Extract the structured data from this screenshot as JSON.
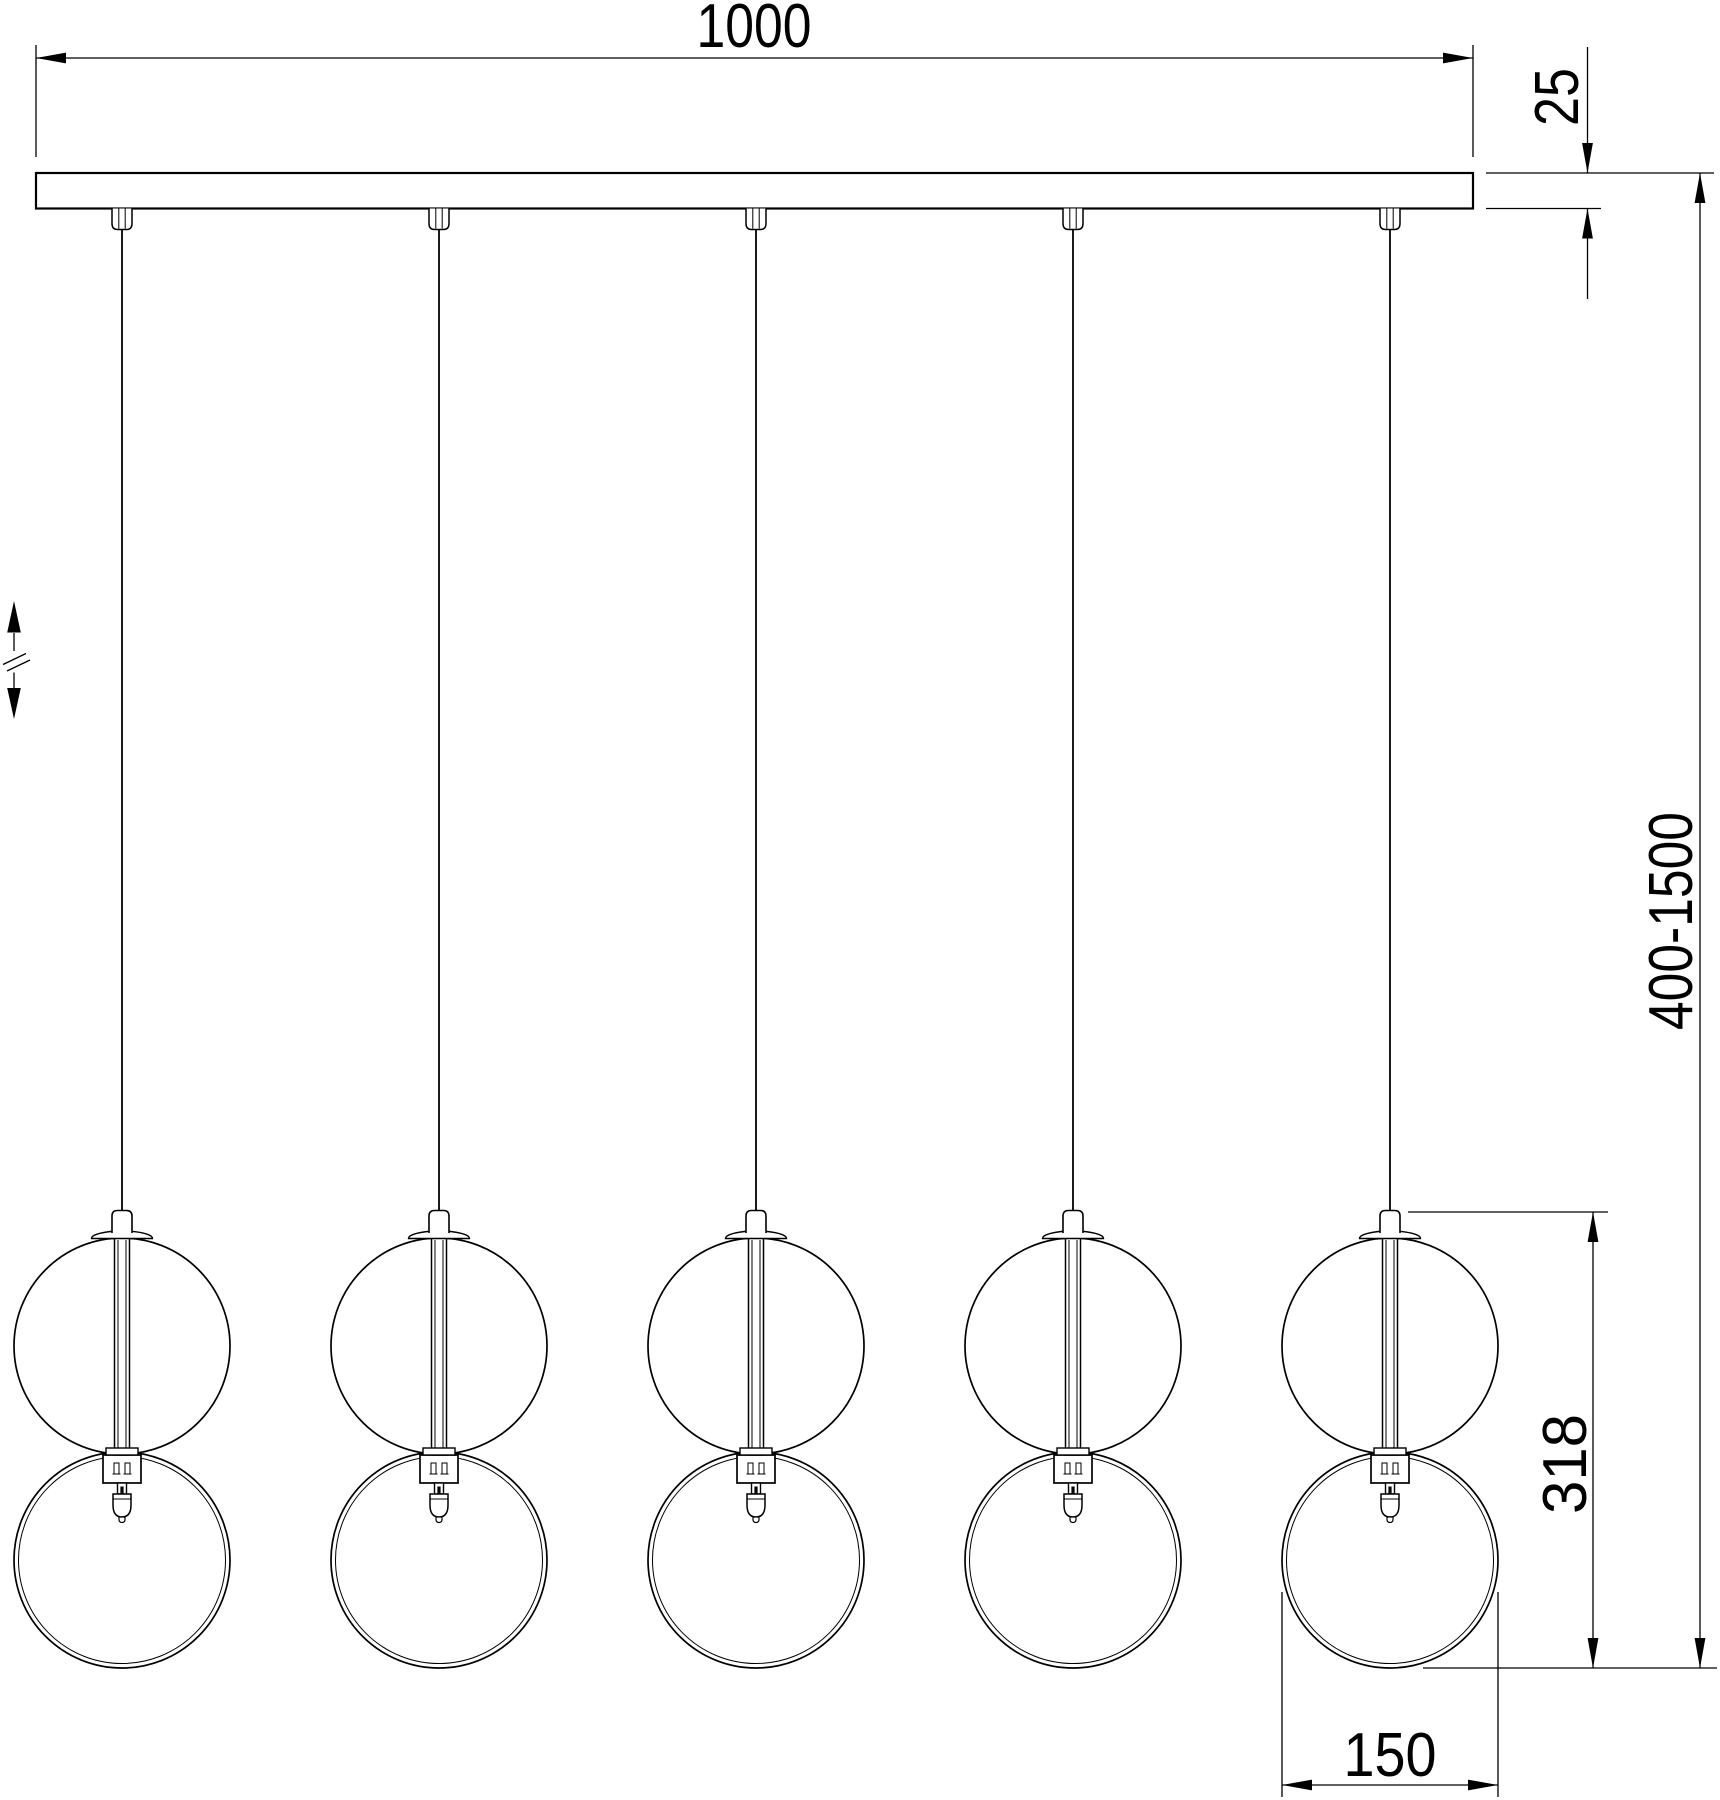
{
  "drawing": {
    "kind": "pendant-luminaire-dimension-drawing",
    "background_color": "#ffffff",
    "line_color": "#000000"
  },
  "dimensions": {
    "overall_width": "1000",
    "canopy_thickness": "25",
    "suspension_range": "400-1500",
    "pendant_height": "318",
    "ring_diameter": "150"
  },
  "fixture": {
    "pendant_count": 5
  },
  "symbols": {
    "height_adjustment_icon": "up-down-arrows-with-break"
  }
}
